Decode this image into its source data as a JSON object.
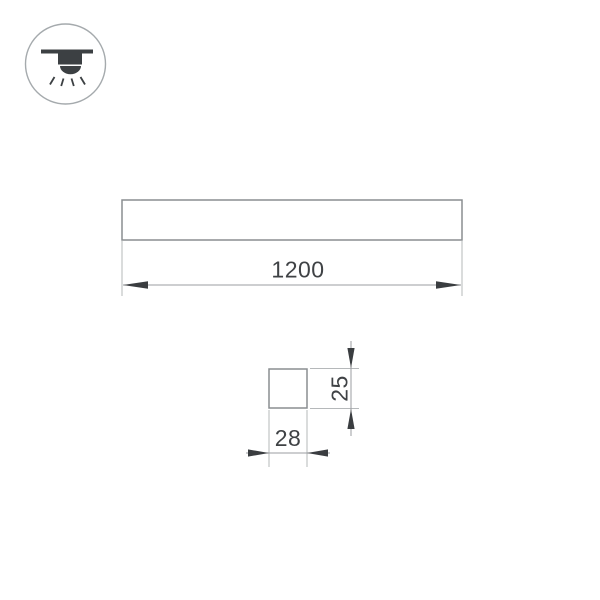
{
  "drawing": {
    "icon": "recessed-linear-ceiling-light",
    "views": {
      "front": "fixture-front-view",
      "section": "fixture-cross-section"
    },
    "dimensions": {
      "length": "1200",
      "height": "25",
      "width": "28"
    }
  },
  "colors": {
    "background": "#ffffff",
    "outline": "#8a8e91",
    "ext_line": "#b5b8ba",
    "dim_line": "#9b9ea1",
    "arrow": "#3a3d40",
    "text": "#3f4245",
    "icon": "#3c4043",
    "icon_ring": "#a5aaad"
  }
}
